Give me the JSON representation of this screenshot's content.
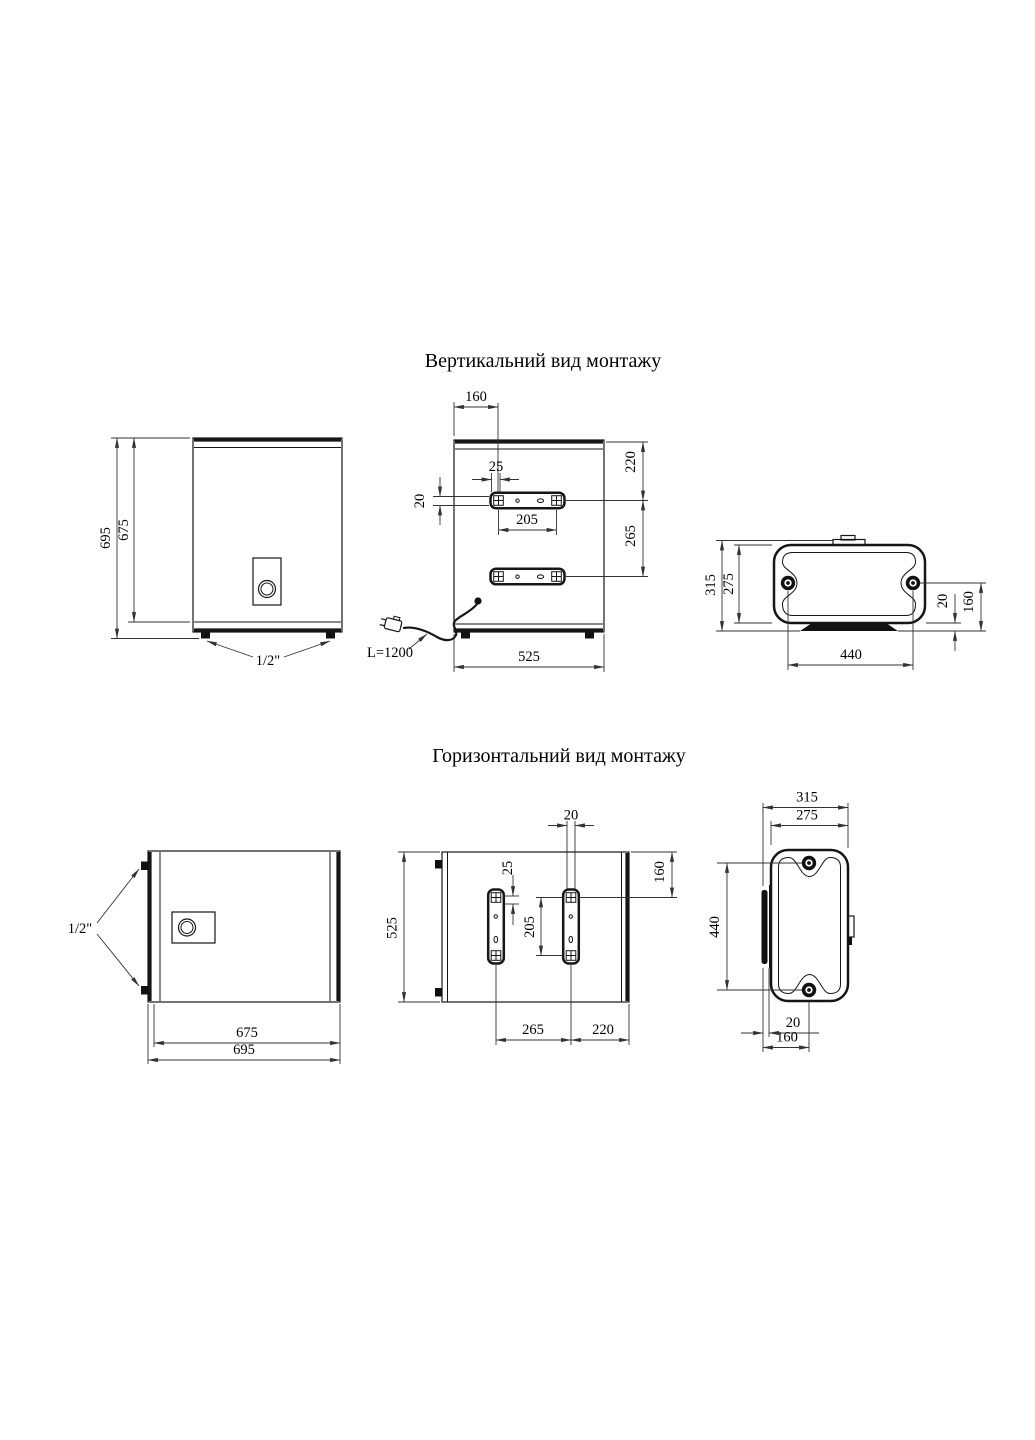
{
  "vertical": {
    "title": "Вертикальний вид монтажу",
    "front": {
      "dim_height_outer": "695",
      "dim_height_body": "675",
      "pipe_label": "1/2\""
    },
    "back": {
      "dim_bracket_offset": "160",
      "dim_slot": "25",
      "dim_bracket_h": "20",
      "dim_hole_span": "205",
      "dim_top_to_bracket": "220",
      "dim_bracket_gap": "265",
      "dim_width": "525",
      "cable_label": "L=1200"
    },
    "top": {
      "dim_depth_outer": "315",
      "dim_depth_body": "275",
      "dim_base_offset": "20",
      "dim_screw_offset": "160",
      "dim_screw_span": "440"
    }
  },
  "horizontal": {
    "title": "Горизонтальний вид монтажу",
    "front": {
      "dim_width_body": "675",
      "dim_width_outer": "695",
      "pipe_label": "1/2\""
    },
    "back": {
      "dim_bracket_w": "20",
      "dim_slot": "25",
      "dim_height": "525",
      "dim_hole_span": "205",
      "dim_top_to_hole": "160",
      "dim_bracket_gap": "265",
      "dim_bracket_to_edge": "220"
    },
    "side": {
      "dim_depth_outer": "315",
      "dim_depth_body": "275",
      "dim_screw_span": "440",
      "dim_base_offset": "20",
      "dim_screw_offset": "160"
    }
  }
}
